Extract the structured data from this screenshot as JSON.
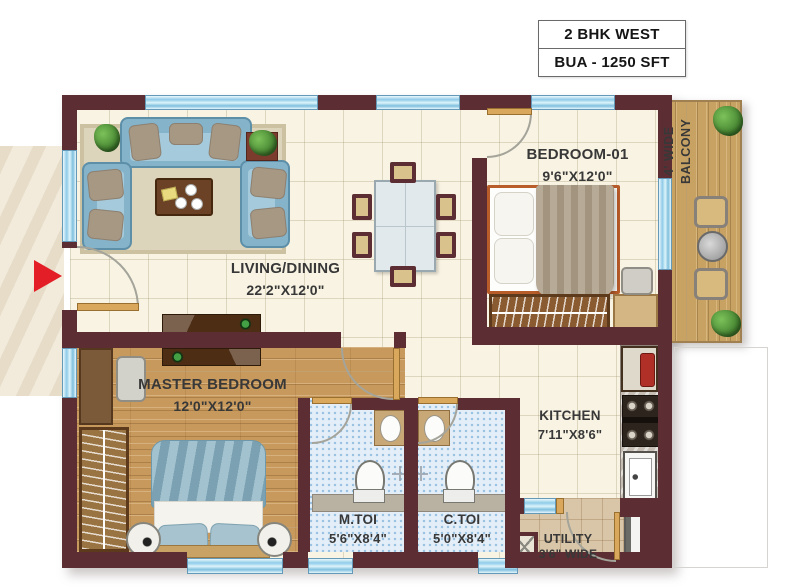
{
  "title": {
    "line1": "2 BHK WEST",
    "line2": "BUA - 1250 SFT"
  },
  "rooms": {
    "living": {
      "name": "LIVING/DINING",
      "size": "22'2\"X12'0\""
    },
    "bedroom01": {
      "name": "BEDROOM-01",
      "size": "9'6\"X12'0\""
    },
    "master": {
      "name": "MASTER BEDROOM",
      "size": "12'0\"X12'0\""
    },
    "kitchen": {
      "name": "KITCHEN",
      "size": "7'11\"X8'6\""
    },
    "mtoi": {
      "name": "M.TOI",
      "size": "5'6\"X8'4\""
    },
    "ctoi": {
      "name": "C.TOI",
      "size": "5'0\"X8'4\""
    },
    "utility": {
      "name": "UTILITY",
      "size": "3'6\" WIDE"
    },
    "balcony": {
      "line1": "4' WIDE",
      "line2": "BALCONY"
    }
  },
  "colors": {
    "wall": "#5c2e34",
    "window": "#a9daf0",
    "entry_arrow": "#e31e26",
    "wood": "#c8995c",
    "sofa": "#84b3ca"
  }
}
